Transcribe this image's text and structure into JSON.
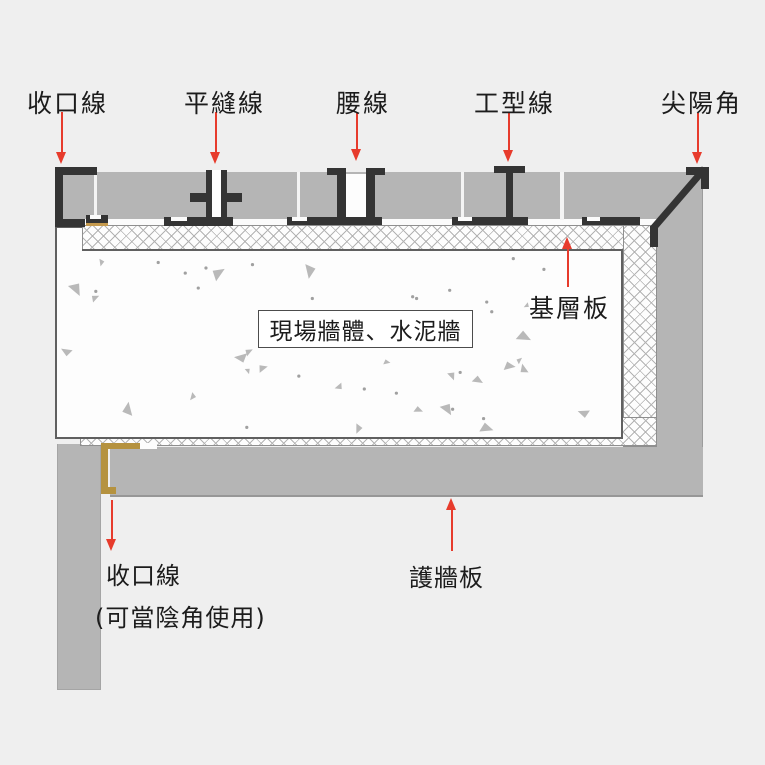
{
  "colors": {
    "accent_red": "#e73b2c",
    "profile_black": "#343434",
    "panel_gray": "#b5b5b5",
    "gold_trim": "#b5923f",
    "background": "#efefef"
  },
  "labels": {
    "top": [
      "收口線",
      "平縫線",
      "腰線",
      "工型線",
      "尖陽角"
    ],
    "base_board": "基層板",
    "wall_box": "現場牆體、水泥牆",
    "bottom_closing": "收口線",
    "bottom_closing_note": "(可當陰角使用)",
    "wall_panel": "護牆板"
  }
}
